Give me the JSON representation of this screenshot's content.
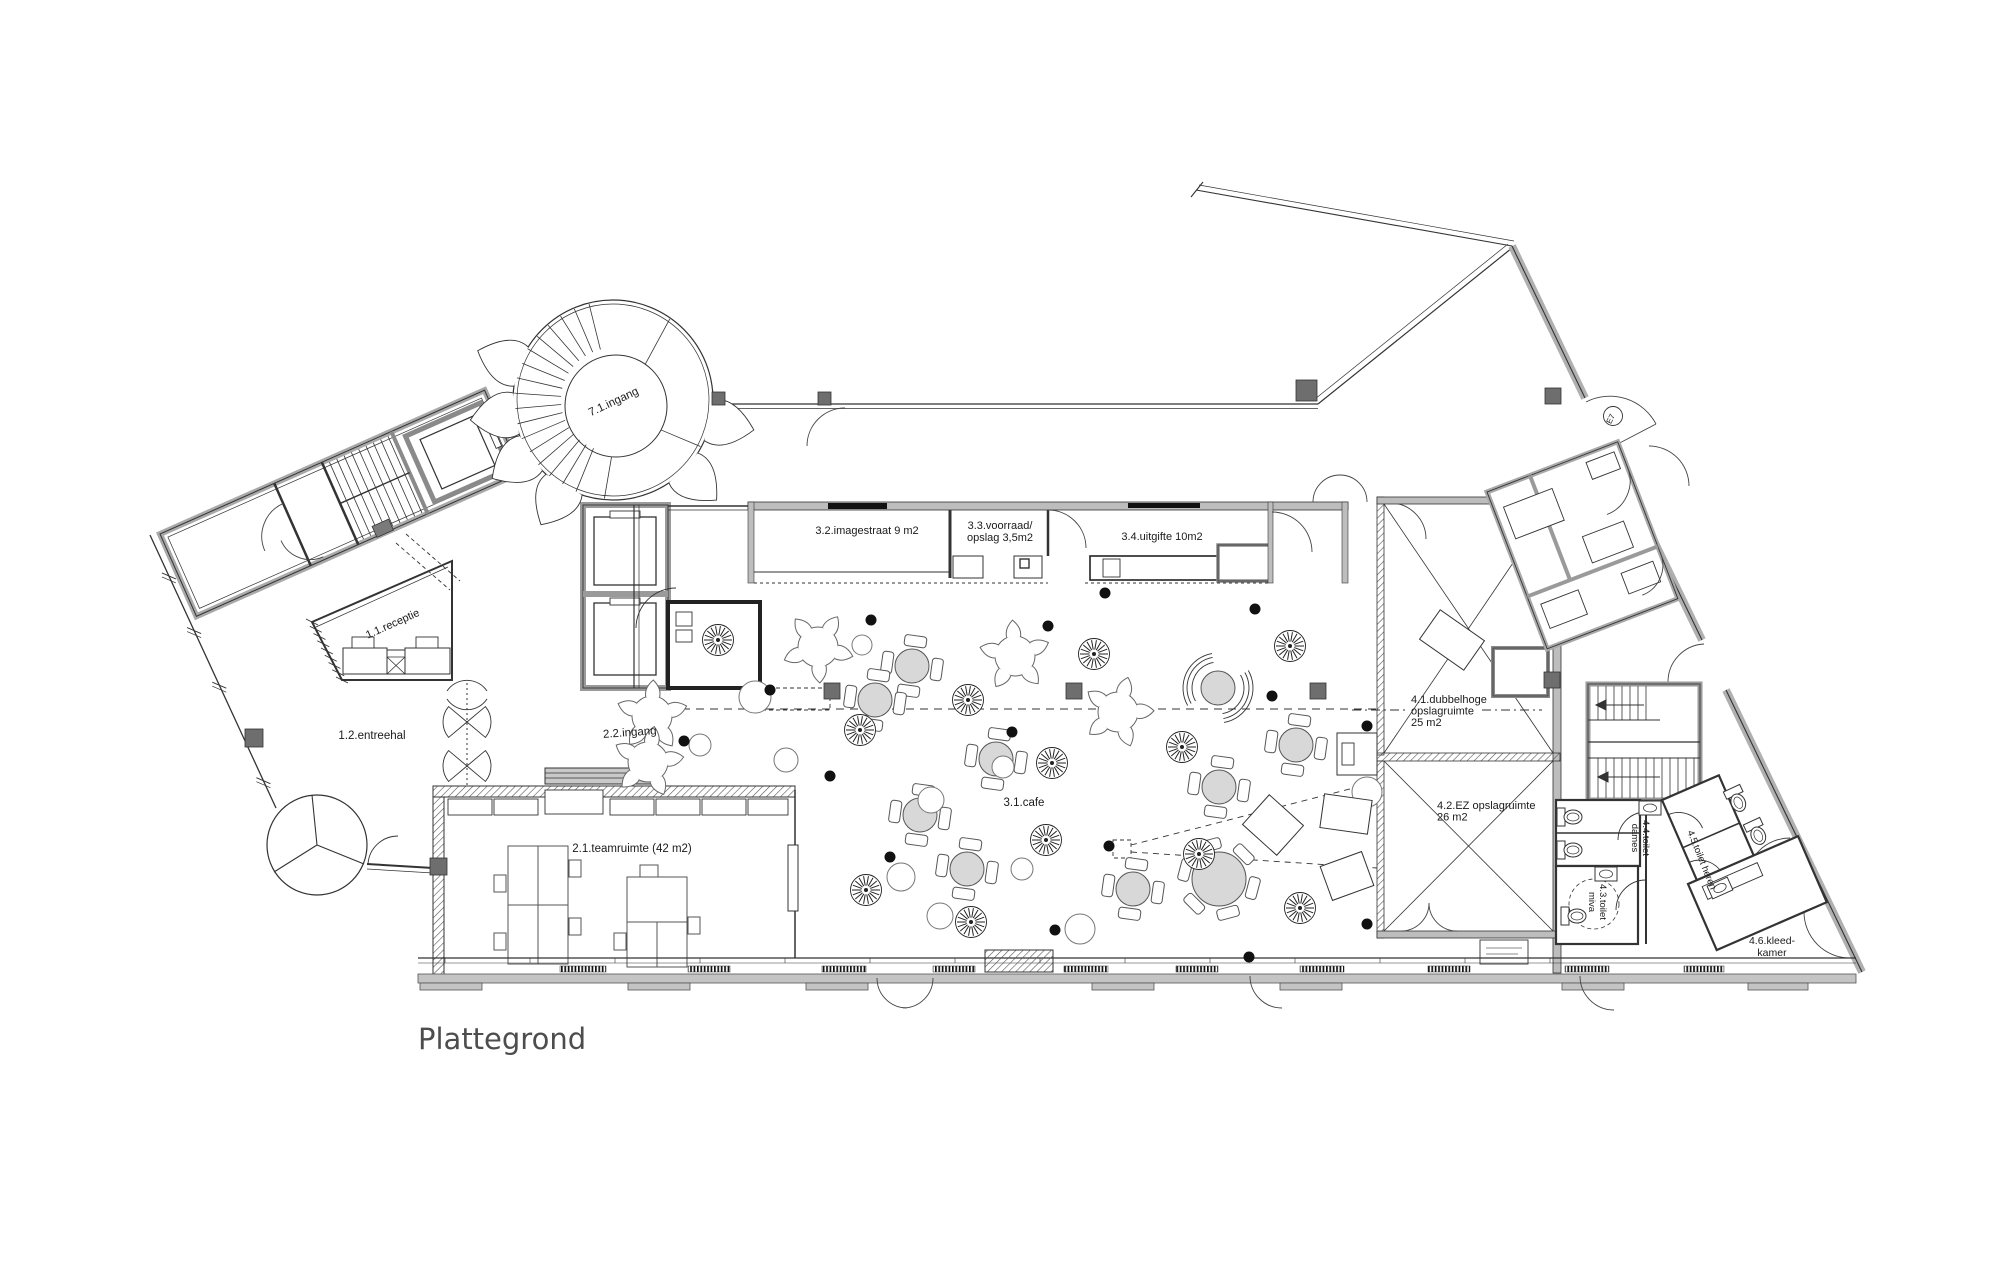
{
  "title": {
    "label": "Plattegrond"
  },
  "colors": {
    "background": "#ffffff",
    "line": "#2b2b2b",
    "wall_gray": "#b5b5b5",
    "furniture_fill": "#d8d8d8",
    "column_gray": "#6e6e6e",
    "title_gray": "#4d4d4d"
  },
  "labels": [
    {
      "name": "room-71-ingang",
      "lines": [
        "7.1.ingang"
      ],
      "x": 615,
      "y": 405,
      "rot": -25,
      "size": 11.5,
      "anchor": "middle"
    },
    {
      "name": "room-11-receptie",
      "lines": [
        "1.1.receptie"
      ],
      "x": 394,
      "y": 627,
      "rot": -24,
      "size": 11,
      "anchor": "middle"
    },
    {
      "name": "room-12-entreehal",
      "lines": [
        "1.2.entreehal"
      ],
      "x": 372,
      "y": 739,
      "rot": 0,
      "size": 11.5,
      "anchor": "middle"
    },
    {
      "name": "room-22-ingang",
      "lines": [
        "2.2.ingang"
      ],
      "x": 630,
      "y": 736,
      "rot": -4,
      "size": 11.5,
      "anchor": "middle"
    },
    {
      "name": "room-21-teamruimte",
      "lines": [
        "2.1.teamruimte (42 m2)"
      ],
      "x": 632,
      "y": 852,
      "rot": 0,
      "size": 11.5,
      "anchor": "middle"
    },
    {
      "name": "room-31-cafe",
      "lines": [
        "3.1.cafe"
      ],
      "x": 1024,
      "y": 806,
      "rot": 0,
      "size": 11.5,
      "anchor": "middle"
    },
    {
      "name": "room-32-imagestraat",
      "lines": [
        "3.2.imagestraat 9 m2"
      ],
      "x": 867,
      "y": 534,
      "rot": 0,
      "size": 11,
      "anchor": "middle"
    },
    {
      "name": "room-33-voorraad",
      "lines": [
        "3.3.voorraad/",
        "opslag 3,5m2"
      ],
      "x": 1000,
      "y": 529,
      "rot": 0,
      "size": 11,
      "anchor": "middle",
      "lh": 12
    },
    {
      "name": "room-34-uitgifte",
      "lines": [
        "3.4.uitgifte 10m2"
      ],
      "x": 1162,
      "y": 540,
      "rot": 0,
      "size": 11,
      "anchor": "middle"
    },
    {
      "name": "room-41-opslag",
      "lines": [
        "4.1.dubbelhoge",
        "opslagruimte",
        "25 m2"
      ],
      "x": 1411,
      "y": 703,
      "rot": 0,
      "size": 11,
      "anchor": "start",
      "lh": 11.5
    },
    {
      "name": "room-42-opslag",
      "lines": [
        "4.2.EZ opslagruimte",
        "26 m2"
      ],
      "x": 1437,
      "y": 809,
      "rot": 0,
      "size": 11,
      "anchor": "start",
      "lh": 11.5
    },
    {
      "name": "room-43-toilet-miva",
      "lines": [
        "4.3.toilet",
        "miva"
      ],
      "x": 1600,
      "y": 902,
      "rot": 90,
      "size": 9.5,
      "anchor": "middle",
      "lh": 11
    },
    {
      "name": "room-44-toilet-dames",
      "lines": [
        "4.4.toilet",
        "dames"
      ],
      "x": 1643,
      "y": 838,
      "rot": 90,
      "size": 9.5,
      "anchor": "middle",
      "lh": 11
    },
    {
      "name": "room-45-toilet-heren",
      "lines": [
        "4.5.toilet heren"
      ],
      "x": 1699,
      "y": 861,
      "rot": 68,
      "size": 9.5,
      "anchor": "middle"
    },
    {
      "name": "room-46-kleedkamer",
      "lines": [
        "4.6.kleed-",
        "kamer"
      ],
      "x": 1772,
      "y": 944,
      "rot": 0,
      "size": 10.5,
      "anchor": "middle",
      "lh": 12
    },
    {
      "name": "door-tag-e7",
      "lines": [
        "E7"
      ],
      "x": 1613,
      "y": 420,
      "rot": -64,
      "size": 8,
      "anchor": "middle"
    }
  ],
  "furniture": {
    "round_tables": [
      [
        912,
        666
      ],
      [
        996,
        759
      ],
      [
        920,
        815
      ],
      [
        967,
        869
      ],
      [
        1133,
        889
      ],
      [
        1296,
        745
      ],
      [
        1219,
        787
      ],
      [
        875,
        700
      ]
    ],
    "large_tables": [
      [
        1219,
        879
      ]
    ],
    "rattan_chairs": [
      [
        718,
        640
      ],
      [
        860,
        730
      ],
      [
        968,
        700
      ],
      [
        1094,
        654
      ],
      [
        1290,
        646
      ],
      [
        1052,
        763
      ],
      [
        1182,
        747
      ],
      [
        1199,
        854
      ],
      [
        1046,
        840
      ],
      [
        971,
        922
      ],
      [
        866,
        890
      ],
      [
        1300,
        908
      ]
    ],
    "fan_lounges": [
      [
        818,
        647,
        -15
      ],
      [
        1015,
        656,
        20
      ],
      [
        1118,
        712,
        40
      ],
      [
        652,
        716,
        170
      ],
      [
        648,
        762,
        250
      ]
    ],
    "arc_booths": [
      [
        1218,
        688,
        25
      ]
    ],
    "stools": [
      [
        755,
        697,
        16
      ],
      [
        1003,
        767,
        11
      ],
      [
        901,
        877,
        14
      ],
      [
        940,
        916,
        13
      ],
      [
        1022,
        869,
        11
      ],
      [
        1080,
        929,
        15
      ],
      [
        931,
        800,
        13
      ],
      [
        786,
        760,
        12
      ],
      [
        862,
        645,
        10
      ],
      [
        700,
        745,
        11
      ],
      [
        1367,
        792,
        15
      ]
    ],
    "dots": [
      [
        871,
        620
      ],
      [
        1048,
        626
      ],
      [
        1105,
        593
      ],
      [
        1255,
        609
      ],
      [
        770,
        690
      ],
      [
        684,
        741
      ],
      [
        830,
        776
      ],
      [
        890,
        857
      ],
      [
        1109,
        846
      ],
      [
        1055,
        930
      ],
      [
        1249,
        957
      ],
      [
        1272,
        696
      ],
      [
        1367,
        726
      ],
      [
        1367,
        924
      ],
      [
        1012,
        732
      ]
    ],
    "columns": [
      [
        824,
        683,
        16
      ],
      [
        1066,
        683,
        16
      ],
      [
        1310,
        683,
        16
      ],
      [
        712,
        392,
        13
      ],
      [
        818,
        392,
        13
      ],
      [
        1296,
        380,
        21
      ],
      [
        1544,
        672,
        16
      ],
      [
        1545,
        388,
        16
      ],
      [
        245,
        729,
        18
      ],
      [
        430,
        858,
        17
      ]
    ],
    "angled_boxes": [
      [
        1273,
        825,
        46,
        40,
        42
      ],
      [
        1346,
        814,
        48,
        34,
        8
      ],
      [
        1347,
        876,
        44,
        36,
        -20
      ],
      [
        1452,
        640,
        54,
        36,
        35
      ]
    ],
    "lecterns": [
      [
        1337,
        733,
        40,
        42
      ]
    ],
    "toilets": [
      [
        1570,
        817,
        90
      ],
      [
        1570,
        850,
        90
      ],
      [
        1574,
        916,
        90
      ],
      [
        1737,
        800,
        155
      ],
      [
        1757,
        833,
        155
      ]
    ],
    "sinks": [
      [
        1650,
        808,
        0
      ],
      [
        1606,
        874,
        0
      ],
      [
        1720,
        888,
        -24
      ]
    ]
  }
}
